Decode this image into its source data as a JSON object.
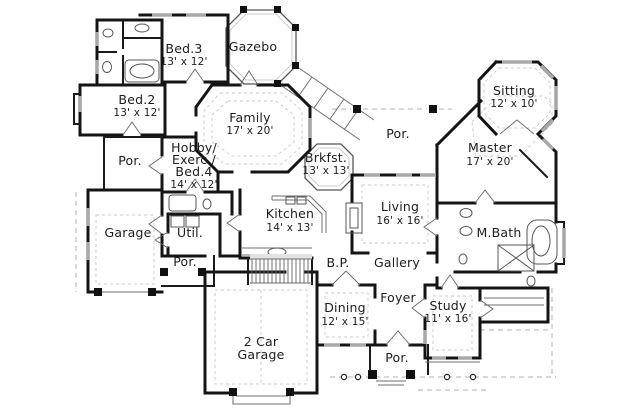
{
  "plan": {
    "kind": "house floor plan",
    "colors": {
      "walls": "#141414",
      "windows": "#a8a8a8",
      "text": "#1c1c1c",
      "background": "#ffffff"
    },
    "rooms": {
      "bed3": {
        "label": "Bed.3",
        "dims": "13' x 12'"
      },
      "gazebo": {
        "label": "Gazebo"
      },
      "bed2": {
        "label": "Bed.2",
        "dims": "13' x 12'"
      },
      "family": {
        "label": "Family",
        "dims": "17' x 20'"
      },
      "sitting": {
        "label": "Sitting",
        "dims": "12' x 10'"
      },
      "por_left": {
        "label": "Por."
      },
      "hobby": {
        "line1": "Hobby/",
        "line2": "Exerc./",
        "line3": "Bed.4",
        "dims": "14' x 12'"
      },
      "brkfst": {
        "label": "Brkfst.",
        "dims": "13' x 13'"
      },
      "master": {
        "label": "Master",
        "dims": "17' x 20'"
      },
      "por_top": {
        "label": "Por."
      },
      "garage": {
        "label": "Garage"
      },
      "util": {
        "label": "Util."
      },
      "kitchen": {
        "label": "Kitchen",
        "dims": "14' x 13'"
      },
      "living": {
        "label": "Living",
        "dims": "16' x 16'"
      },
      "mbath": {
        "label": "M.Bath"
      },
      "por_garage": {
        "label": "Por."
      },
      "bp": {
        "label": "B.P."
      },
      "gallery": {
        "label": "Gallery"
      },
      "dining": {
        "label": "Dining",
        "dims": "12' x 15'"
      },
      "foyer": {
        "label": "Foyer"
      },
      "study": {
        "label": "Study",
        "dims": "11' x 16'"
      },
      "garage2": {
        "line1": "2 Car",
        "line2": "Garage"
      },
      "por_bottom": {
        "label": "Por."
      }
    }
  }
}
